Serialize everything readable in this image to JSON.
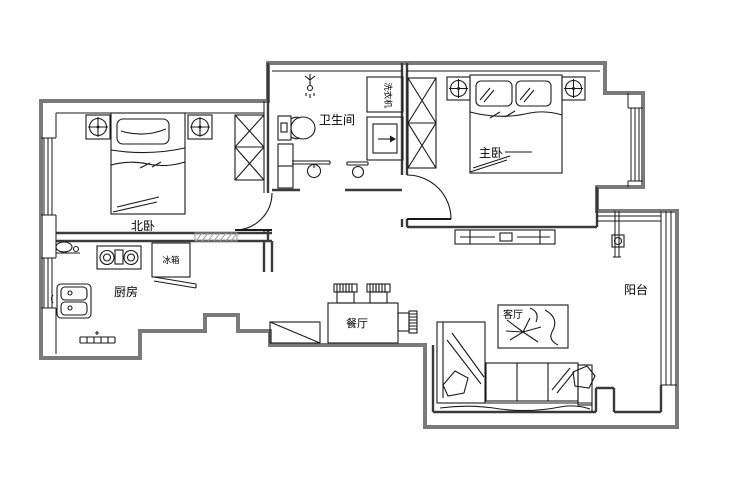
{
  "plan_title": "apartment-floor-plan",
  "rooms": {
    "north_bedroom": "北卧",
    "bathroom": "卫生间",
    "master_bedroom": "主卧",
    "kitchen": "厨房",
    "dining": "餐厅",
    "living": "客厅",
    "balcony": "阳台"
  },
  "appliances": {
    "washing_machine": "洗衣机",
    "fridge": "冰箱"
  },
  "colors": {
    "background": "#ffffff",
    "outer_wall": "#7a7a7a",
    "partition_wall": "#3a3a3a",
    "drawing_line": "#1a1a1a"
  }
}
